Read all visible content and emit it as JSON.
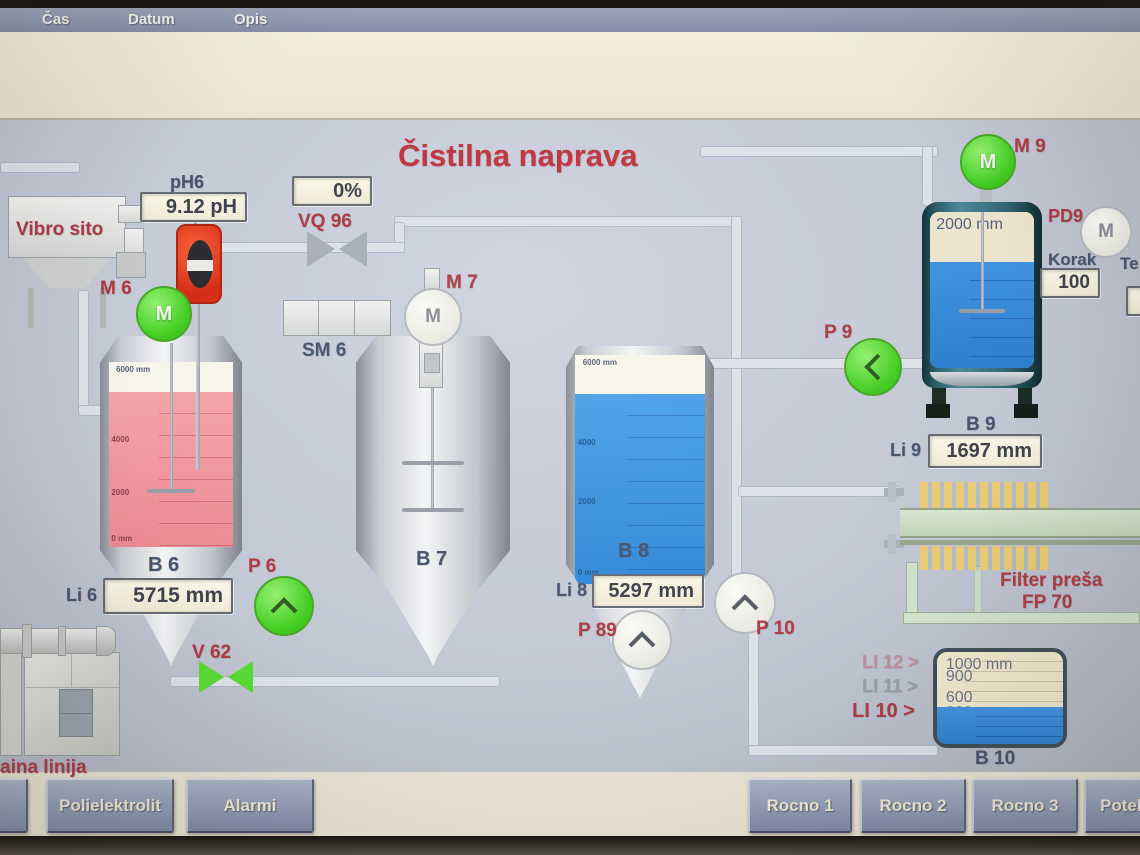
{
  "alarm_header": {
    "time": "Čas",
    "date": "Datum",
    "description": "Opis"
  },
  "title": "Čistilna naprava",
  "colors": {
    "running_green": "#3fd01e",
    "alarm_red": "#b13a45",
    "liquid_blue": "#3391e2",
    "liquid_pink": "#f295a0"
  },
  "devices": {
    "vibro_sito": {
      "label": "Vibro sito"
    },
    "ph6": {
      "label": "pH6",
      "value": "9.12 pH"
    },
    "m6": {
      "label": "M 6",
      "symbol": "M"
    },
    "vq96": {
      "label": "VQ 96",
      "value": "0%"
    },
    "sm6": {
      "label": "SM 6"
    },
    "m7": {
      "label": "M 7",
      "symbol": "M"
    },
    "b6": {
      "label": "B 6",
      "scale_top": "6000 mm",
      "scale_mid": "4000",
      "scale_low": "2000",
      "scale_zero": "0 mm",
      "level_label": "Li 6",
      "level_value": "5715 mm"
    },
    "p6": {
      "label": "P 6"
    },
    "v62": {
      "label": "V 62"
    },
    "b7": {
      "label": "B 7"
    },
    "b8": {
      "label": "B 8",
      "scale_top": "6000 mm",
      "scale_mid": "4000",
      "scale_low": "2000",
      "scale_zero": "0 mm",
      "level_label": "Li 8",
      "level_value": "5297 mm"
    },
    "p89": {
      "label": "P 89"
    },
    "p10": {
      "label": "P 10"
    },
    "p9": {
      "label": "P 9"
    },
    "m9": {
      "label": "M 9",
      "symbol": "M"
    },
    "b9": {
      "label": "B 9",
      "scale_top": "2000 mm",
      "level_label": "Li 9",
      "level_value": "1697 mm"
    },
    "pd9": {
      "label": "PD9",
      "symbol": "M"
    },
    "korak": {
      "label": "Korak",
      "value": "100"
    },
    "te": {
      "label": "Te"
    },
    "filter_press": {
      "name": "Filter preša",
      "tag": "FP 70"
    },
    "b10": {
      "label": "B 10",
      "scale_top": "1000 mm",
      "scale_900": "900",
      "scale_600": "600",
      "scale_300": "300"
    },
    "li12": {
      "label": "LI 12 >"
    },
    "li11": {
      "label": "LI 11 >"
    },
    "li10": {
      "label": "LI 10 >"
    },
    "sludge_line": {
      "label": "aina linija"
    }
  },
  "buttons": {
    "polielektrolit": "Polielektrolit",
    "alarmi": "Alarmi",
    "rocno1": "Rocno 1",
    "rocno2": "Rocno 2",
    "rocno3": "Rocno 3",
    "potek": "Potek"
  }
}
